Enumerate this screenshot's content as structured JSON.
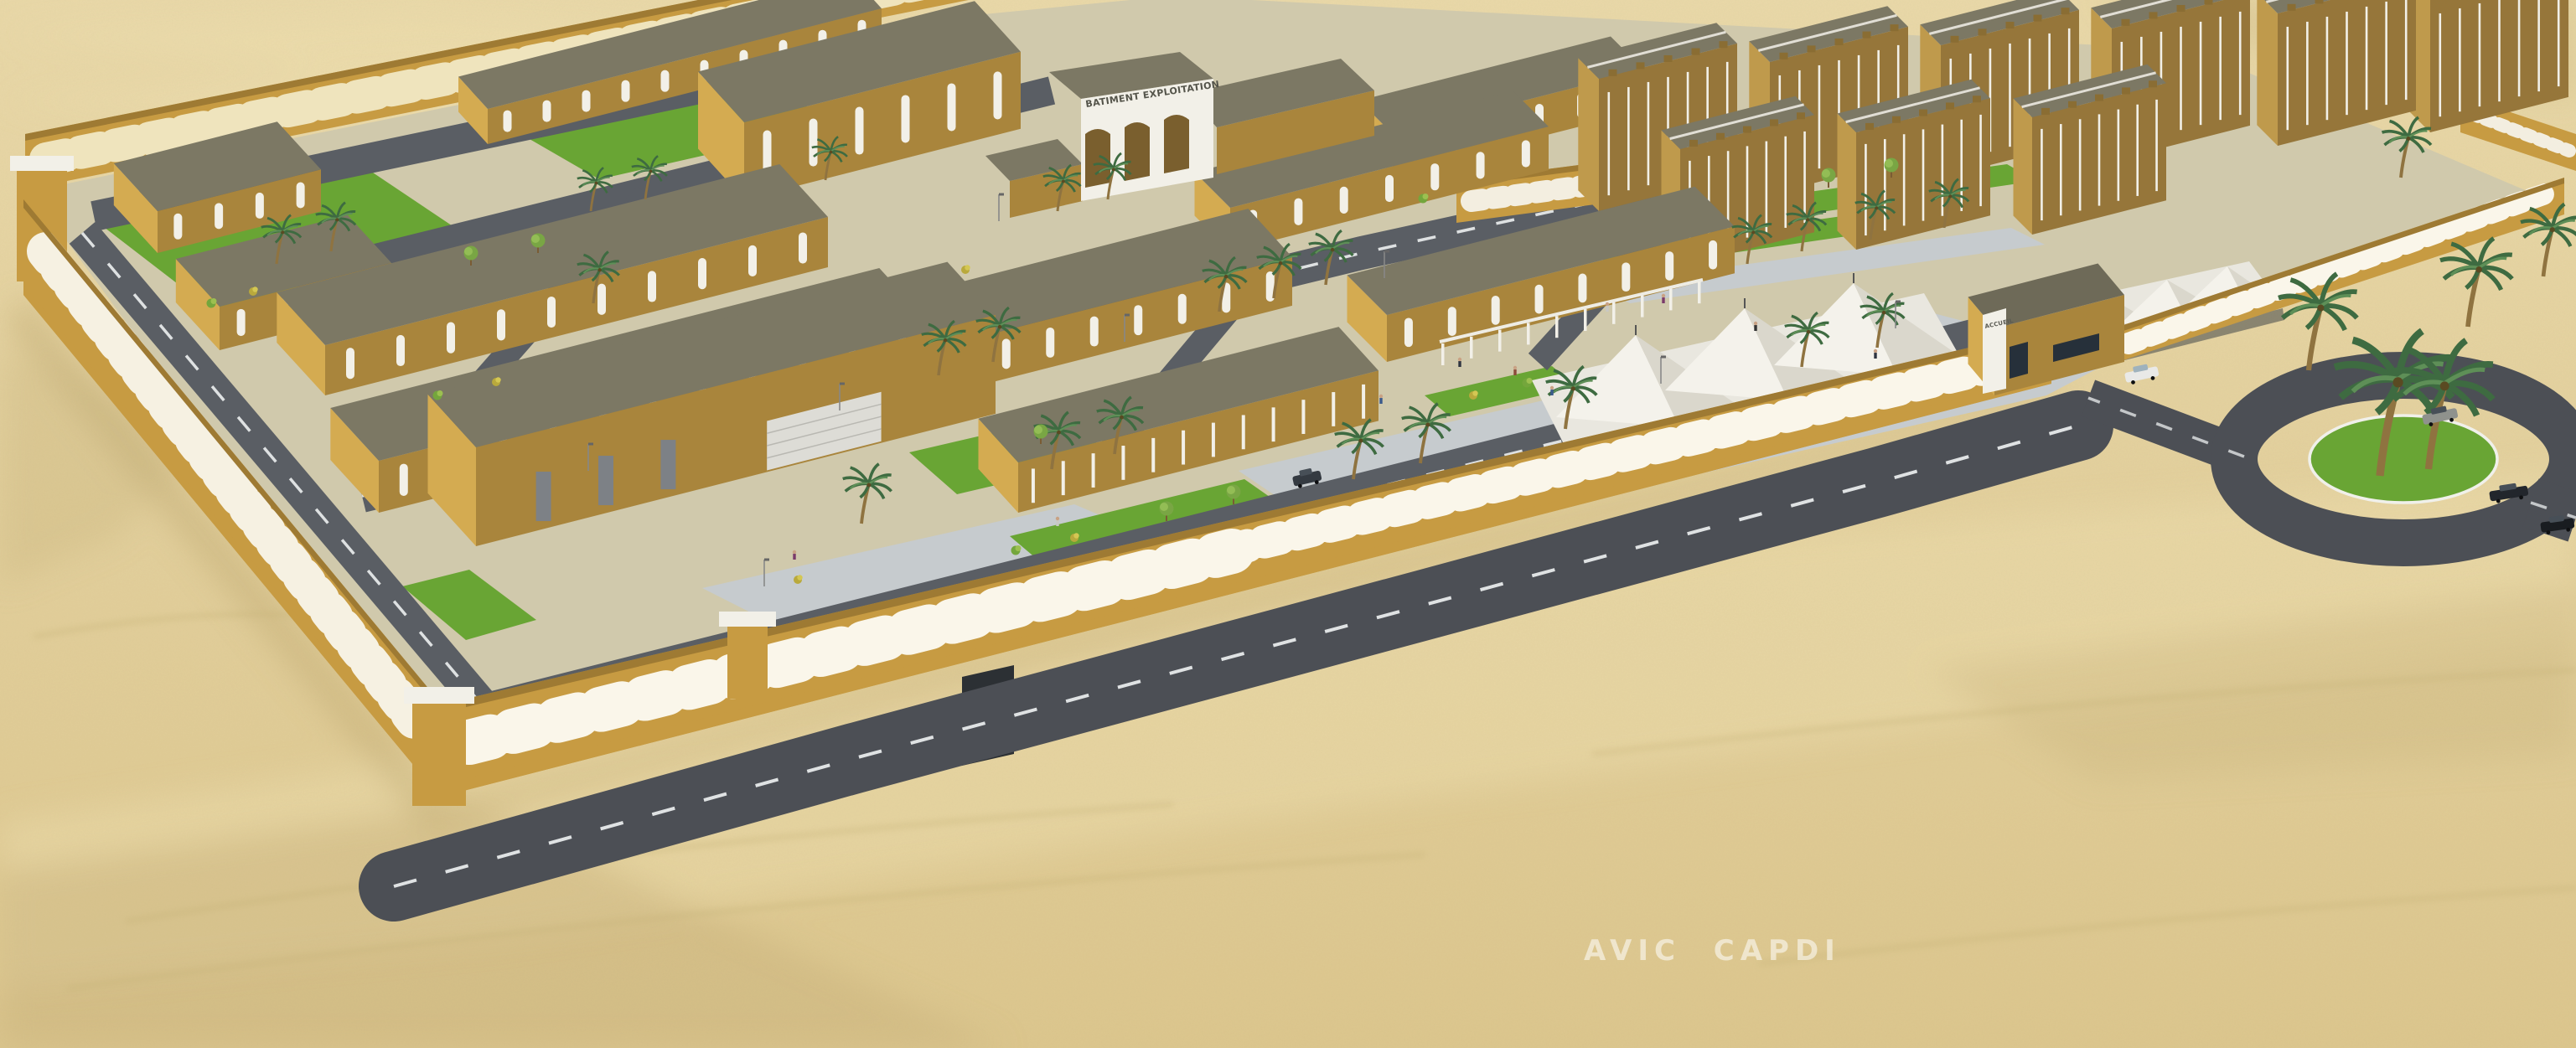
{
  "scene": {
    "type": "architectural-3d-rendering",
    "description": "Aerial 3D rendering of a walled desert compound: ochre flat-roofed buildings with olive roofs and white arched trim, arched perimeter wall, palm trees, white shade canopies over parking, internal roads, entrance gatehouse and an external roundabout, all surrounded by sand dunes.",
    "signs": {
      "batiment_exploitation": "BATIMENT EXPLOITATION",
      "accueil": "ACCUEIL"
    },
    "watermark": {
      "text": "AVIC CAPDI"
    }
  },
  "palette": {
    "sand": "#e5d2a0",
    "sand_light": "#efe0b2",
    "sand_shadow": "#cbb67f",
    "ground": "#d0c9ac",
    "wall_face": "#c79b42",
    "wall_dark": "#9e7a33",
    "white_trim": "#f2f0e8",
    "bld_front": "#a9853c",
    "bld_side": "#d4ab51",
    "apt_front": "#96763a",
    "apt_side": "#bf9a4c",
    "roof": "#7c7864",
    "grass": "#69a534",
    "plaza": "#c6cbce",
    "road": "#4c4f55",
    "road_in": "#5a5e64",
    "road_line": "#eceff0",
    "tent": "#e9e7df",
    "palm": "#3e6b41",
    "trunk": "#8f7340",
    "car_dark": "#1c2024",
    "watermark": "#ffffff"
  }
}
